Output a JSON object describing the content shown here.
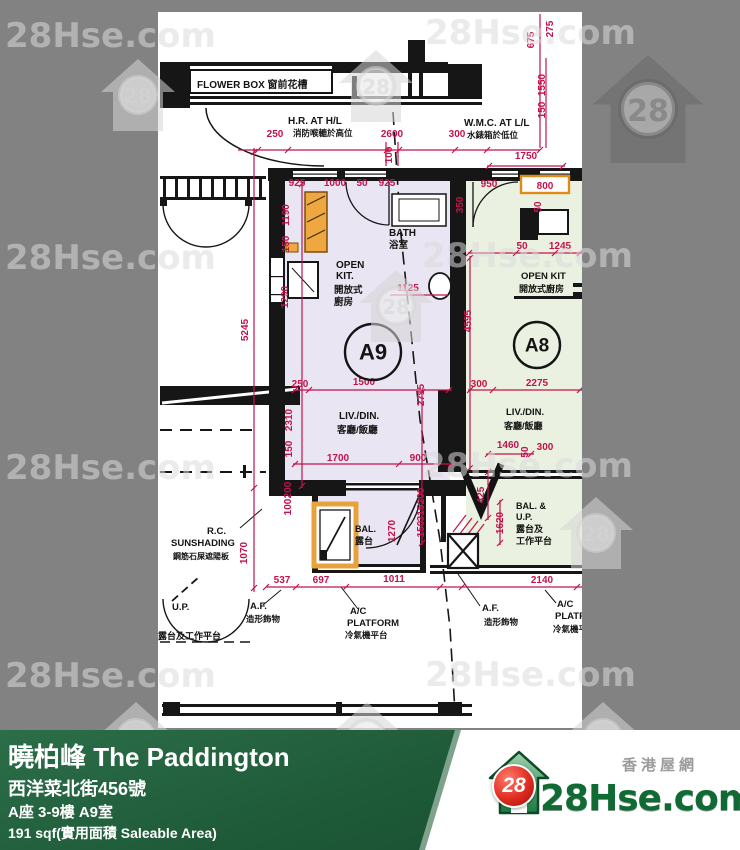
{
  "watermark": {
    "text": "28Hse.com",
    "badge": "28",
    "text_positions": [
      [
        5,
        16
      ],
      [
        425,
        13
      ],
      [
        5,
        238
      ],
      [
        422,
        236
      ],
      [
        5,
        448
      ],
      [
        422,
        446
      ],
      [
        5,
        656
      ],
      [
        425,
        655
      ]
    ],
    "logo_positions": [
      [
        98,
        57
      ],
      [
        336,
        48
      ],
      [
        356,
        268
      ],
      [
        556,
        495
      ],
      [
        96,
        700
      ],
      [
        327,
        700
      ],
      [
        563,
        700
      ]
    ],
    "dark_logo_position": [
      588,
      52
    ]
  },
  "plan": {
    "accent": "#c2134b",
    "room_fill_a9": "#e9e5f2",
    "room_fill_a8": "#ebf1e1",
    "units": [
      {
        "t": "A9",
        "x": 373,
        "y": 352,
        "r": 28,
        "fs": 22
      },
      {
        "t": "A8",
        "x": 537,
        "y": 345,
        "r": 23,
        "fs": 19
      }
    ],
    "labels": [
      {
        "t": "FLOWER BOX  窗前花槽",
        "x": 197,
        "y": 88,
        "s": 10
      },
      {
        "t": "H.R. AT H/L",
        "x": 288,
        "y": 124,
        "s": 10
      },
      {
        "t": "消防喉轆於高位",
        "x": 293,
        "y": 136,
        "s": 8.5
      },
      {
        "t": "W.M.C. AT L/L",
        "x": 464,
        "y": 126,
        "s": 10
      },
      {
        "t": "水錶箱於低位",
        "x": 467,
        "y": 138,
        "s": 8.5
      },
      {
        "t": "OPEN",
        "x": 336,
        "y": 268,
        "s": 10
      },
      {
        "t": "KIT.",
        "x": 336,
        "y": 279,
        "s": 10
      },
      {
        "t": "開放式",
        "x": 334,
        "y": 293,
        "s": 9.5
      },
      {
        "t": "廚房",
        "x": 334,
        "y": 305,
        "s": 9.5
      },
      {
        "t": "BATH",
        "x": 389,
        "y": 236,
        "s": 10
      },
      {
        "t": "浴室",
        "x": 389,
        "y": 248,
        "s": 9.5
      },
      {
        "t": "LIV./DIN.",
        "x": 339,
        "y": 419,
        "s": 10
      },
      {
        "t": "客廳/飯廳",
        "x": 337,
        "y": 433,
        "s": 9.5
      },
      {
        "t": "BAL.",
        "x": 355,
        "y": 532,
        "s": 9
      },
      {
        "t": "露台",
        "x": 355,
        "y": 544,
        "s": 9
      },
      {
        "t": "OPEN KIT",
        "x": 521,
        "y": 279,
        "s": 9.5
      },
      {
        "t": "開放式廚房",
        "x": 519,
        "y": 292,
        "s": 9
      },
      {
        "t": "LIV./DIN.",
        "x": 506,
        "y": 415,
        "s": 9.5
      },
      {
        "t": "客廳/飯廳",
        "x": 504,
        "y": 429,
        "s": 9
      },
      {
        "t": "BAL. &",
        "x": 516,
        "y": 509,
        "s": 9
      },
      {
        "t": "U.P.",
        "x": 516,
        "y": 520,
        "s": 9
      },
      {
        "t": "露台及",
        "x": 516,
        "y": 532,
        "s": 9
      },
      {
        "t": "工作平台",
        "x": 516,
        "y": 544,
        "s": 9
      },
      {
        "t": "R.C.",
        "x": 207,
        "y": 534,
        "s": 9.5
      },
      {
        "t": "SUNSHADING",
        "x": 171,
        "y": 546,
        "s": 9.5
      },
      {
        "t": "鋼筋石屎遮陽板",
        "x": 173,
        "y": 559,
        "s": 8
      },
      {
        "t": "U.P.",
        "x": 172,
        "y": 610,
        "s": 9.5
      },
      {
        "t": "露台及工作平台",
        "x": 158,
        "y": 639,
        "s": 9
      },
      {
        "t": "A.F.",
        "x": 250,
        "y": 609,
        "s": 9.5
      },
      {
        "t": "造形飾物",
        "x": 246,
        "y": 622,
        "s": 8.5
      },
      {
        "t": "A.F.",
        "x": 482,
        "y": 611,
        "s": 9.5
      },
      {
        "t": "造形飾物",
        "x": 484,
        "y": 625,
        "s": 8.5
      },
      {
        "t": "A/C",
        "x": 350,
        "y": 614,
        "s": 9.5
      },
      {
        "t": "PLATFORM",
        "x": 347,
        "y": 626,
        "s": 9.5
      },
      {
        "t": "冷氣機平台",
        "x": 345,
        "y": 638,
        "s": 8.5
      },
      {
        "t": "A/C",
        "x": 557,
        "y": 607,
        "s": 9.5
      },
      {
        "t": "PLATF",
        "x": 555,
        "y": 619,
        "s": 9.5
      },
      {
        "t": "冷氣機平",
        "x": 553,
        "y": 632,
        "s": 8.5
      }
    ],
    "dims": [
      {
        "t": "250",
        "x": 275,
        "y": 137
      },
      {
        "t": "2600",
        "x": 392,
        "y": 137
      },
      {
        "t": "300",
        "x": 457,
        "y": 137
      },
      {
        "t": "100",
        "x": 392,
        "y": 155,
        "r": 1
      },
      {
        "t": "1750",
        "x": 526,
        "y": 159
      },
      {
        "t": "675",
        "x": 534,
        "y": 40,
        "r": 1
      },
      {
        "t": "275",
        "x": 553,
        "y": 29,
        "r": 1
      },
      {
        "t": "1550",
        "x": 545,
        "y": 85,
        "r": 1
      },
      {
        "t": "150",
        "x": 545,
        "y": 110,
        "r": 1
      },
      {
        "t": "925",
        "x": 297,
        "y": 186
      },
      {
        "t": "1000",
        "x": 335,
        "y": 186
      },
      {
        "t": "50",
        "x": 362,
        "y": 186
      },
      {
        "t": "925",
        "x": 387,
        "y": 186
      },
      {
        "t": "950",
        "x": 489,
        "y": 187
      },
      {
        "t": "800",
        "x": 545,
        "y": 189
      },
      {
        "t": "350",
        "x": 463,
        "y": 205,
        "r": 1
      },
      {
        "t": "50",
        "x": 541,
        "y": 207,
        "r": 1
      },
      {
        "t": "50",
        "x": 522,
        "y": 249
      },
      {
        "t": "1245",
        "x": 560,
        "y": 249
      },
      {
        "t": "1190",
        "x": 289,
        "y": 215,
        "r": 1
      },
      {
        "t": "150",
        "x": 289,
        "y": 244,
        "r": 1
      },
      {
        "t": "1290",
        "x": 288,
        "y": 297,
        "r": 1
      },
      {
        "t": "1125",
        "x": 408,
        "y": 291
      },
      {
        "t": "5245",
        "x": 248,
        "y": 330,
        "r": 1
      },
      {
        "t": "4595",
        "x": 471,
        "y": 321,
        "r": 1
      },
      {
        "t": "2310",
        "x": 292,
        "y": 420,
        "r": 1
      },
      {
        "t": "150",
        "x": 292,
        "y": 449,
        "r": 1
      },
      {
        "t": "2715",
        "x": 424,
        "y": 395,
        "r": 1
      },
      {
        "t": "250",
        "x": 300,
        "y": 387
      },
      {
        "t": "1500",
        "x": 364,
        "y": 385
      },
      {
        "t": "300",
        "x": 479,
        "y": 387
      },
      {
        "t": "2275",
        "x": 537,
        "y": 386
      },
      {
        "t": "1700",
        "x": 338,
        "y": 461
      },
      {
        "t": "900",
        "x": 418,
        "y": 461
      },
      {
        "t": "1460",
        "x": 508,
        "y": 448
      },
      {
        "t": "50",
        "x": 528,
        "y": 452,
        "r": 1
      },
      {
        "t": "300",
        "x": 545,
        "y": 450
      },
      {
        "t": "200",
        "x": 291,
        "y": 490,
        "r": 1
      },
      {
        "t": "100",
        "x": 291,
        "y": 507,
        "r": 1
      },
      {
        "t": "200",
        "x": 424,
        "y": 496,
        "r": 1
      },
      {
        "t": "315",
        "x": 424,
        "y": 513,
        "r": 1
      },
      {
        "t": "150",
        "x": 424,
        "y": 529,
        "r": 1
      },
      {
        "t": "1270",
        "x": 395,
        "y": 531,
        "r": 1
      },
      {
        "t": "425",
        "x": 484,
        "y": 495,
        "r": 1
      },
      {
        "t": "1620",
        "x": 503,
        "y": 523,
        "r": 1
      },
      {
        "t": "1070",
        "x": 247,
        "y": 553,
        "r": 1
      },
      {
        "t": "537",
        "x": 282,
        "y": 583
      },
      {
        "t": "697",
        "x": 321,
        "y": 583
      },
      {
        "t": "1011",
        "x": 394,
        "y": 582
      },
      {
        "t": "2140",
        "x": 542,
        "y": 583
      }
    ]
  },
  "footer": {
    "title": "曉柏峰 The Paddington",
    "address": "西洋菜北街456號",
    "unit": "A座 3-9樓 A9室",
    "area": "191 sqf(實用面積 Saleable Area)",
    "brand_small": "香港屋網",
    "brand": "28Hse.com",
    "badge": "28"
  }
}
